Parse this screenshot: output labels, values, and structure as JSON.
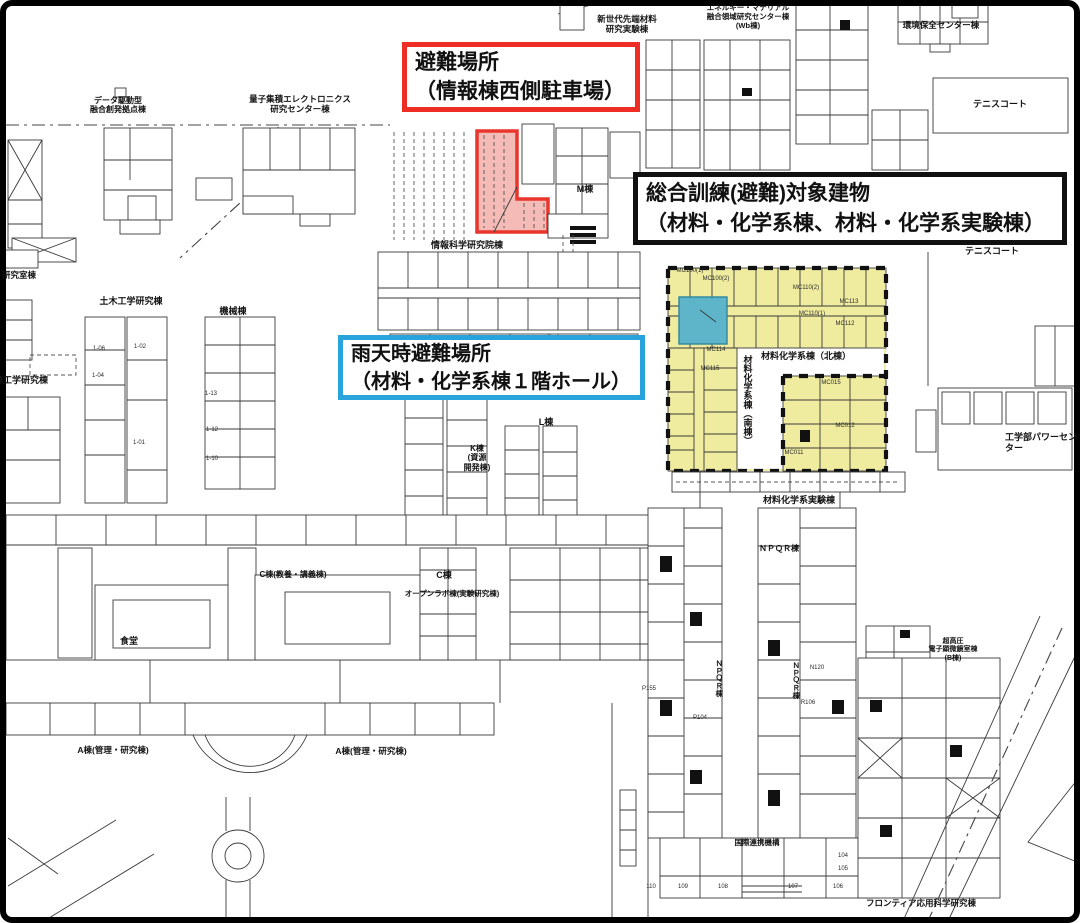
{
  "callouts": {
    "evacuation_site": {
      "line1": "避難場所",
      "line2": "（情報棟西側駐車場）",
      "border_color": "#ee2e24"
    },
    "training_target": {
      "line1": "総合訓練(避難)対象建物",
      "line2": "（材料・化学系棟、材料・化学系実験棟）",
      "border_color": "#111111"
    },
    "rainy_day_site": {
      "line1": "雨天時避難場所",
      "line2": "（材料・化学系棟１階ホール）",
      "border_color": "#29a3dc"
    }
  },
  "map": {
    "highlight_colors": {
      "parking_fill": "#f2aaa5",
      "parking_stroke": "#e8362c",
      "buildings_fill": "#efec9f",
      "hall_fill": "#5eb5ca",
      "hall_stroke": "#2e86a0",
      "dash_border": "#111111"
    },
    "labels": [
      {
        "text": "データ駆動型\n融合創発拠点棟",
        "x": 118,
        "y": 96,
        "fs": 8
      },
      {
        "text": "量子集積エレクトロニクス\n研究センター棟",
        "x": 300,
        "y": 94,
        "fs": 8.5
      },
      {
        "text": "新世代先端材料\n研究実験棟",
        "x": 627,
        "y": 14,
        "fs": 8.5
      },
      {
        "text": "エネルギー・マテリアル\n融合領域研究センター棟\n(Wb棟)",
        "x": 748,
        "y": 4,
        "fs": 7.5
      },
      {
        "text": "環境保全センター棟",
        "x": 941,
        "y": 20,
        "fs": 8.5
      },
      {
        "text": "テニスコート",
        "x": 1000,
        "y": 99,
        "fs": 9
      },
      {
        "text": "テニスコート",
        "x": 992,
        "y": 246,
        "fs": 9
      },
      {
        "text": "情報科学研究院棟",
        "x": 467,
        "y": 240,
        "fs": 9
      },
      {
        "text": "M棟",
        "x": 585,
        "y": 184,
        "fs": 9
      },
      {
        "text": "材料化学系棟（北棟）",
        "x": 806,
        "y": 351,
        "fs": 9
      },
      {
        "text": "材料化学系棟（南棟）",
        "x": 747,
        "y": 400,
        "fs": 9,
        "vert": true
      },
      {
        "text": "材料化学系実験棟",
        "x": 799,
        "y": 495,
        "fs": 9
      },
      {
        "text": "工学部パワーセンター",
        "x": 1005,
        "y": 432,
        "fs": 9,
        "align": "left"
      },
      {
        "text": "研究室棟",
        "x": 2,
        "y": 270,
        "fs": 8.5,
        "align": "left"
      },
      {
        "text": "土木工学研究棟",
        "x": 131,
        "y": 296,
        "fs": 9
      },
      {
        "text": "機械棟",
        "x": 233,
        "y": 306,
        "fs": 9
      },
      {
        "text": "境工学研究棟",
        "x": -6,
        "y": 375,
        "fs": 9,
        "align": "left"
      },
      {
        "text": "K棟\n(資源\n開発棟)",
        "x": 477,
        "y": 444,
        "fs": 8
      },
      {
        "text": "L棟",
        "x": 546,
        "y": 417,
        "fs": 9
      },
      {
        "text": "C棟",
        "x": 444,
        "y": 570,
        "fs": 9
      },
      {
        "text": "オープンラボ棟(実験研究棟)",
        "x": 452,
        "y": 590,
        "fs": 7.5
      },
      {
        "text": "C棟(教養・講義棟)",
        "x": 293,
        "y": 570,
        "fs": 8
      },
      {
        "text": "食堂",
        "x": 129,
        "y": 636,
        "fs": 9
      },
      {
        "text": "A棟(管理・研究棟)",
        "x": 113,
        "y": 745,
        "fs": 8.5
      },
      {
        "text": "A棟(管理・研究棟)",
        "x": 371,
        "y": 746,
        "fs": 8.5
      },
      {
        "text": "ＮＰＱＲ棟",
        "x": 779,
        "y": 544,
        "fs": 8
      },
      {
        "text": "ＮＰＱＲ棟",
        "x": 719,
        "y": 678,
        "fs": 7.5,
        "vert": true
      },
      {
        "text": "ＮＰＱＲ棟",
        "x": 796,
        "y": 680,
        "fs": 7.5,
        "vert": true
      },
      {
        "text": "国際連携機構",
        "x": 757,
        "y": 839,
        "fs": 7.5
      },
      {
        "text": "フロンティア応用科学研究棟",
        "x": 921,
        "y": 898,
        "fs": 8.5
      },
      {
        "text": "超高圧\n電子顕微鏡室棟\n(B棟)",
        "x": 953,
        "y": 638,
        "fs": 7
      },
      {
        "text": "MC100(1)",
        "x": 690,
        "y": 268,
        "fs": 6,
        "small": true
      },
      {
        "text": "MC100(2)",
        "x": 716,
        "y": 276,
        "fs": 6,
        "small": true
      },
      {
        "text": "MC110(2)",
        "x": 806,
        "y": 285,
        "fs": 6,
        "small": true
      },
      {
        "text": "MC110(1)",
        "x": 812,
        "y": 311,
        "fs": 6,
        "small": true
      },
      {
        "text": "MC112",
        "x": 845,
        "y": 321,
        "fs": 6,
        "small": true
      },
      {
        "text": "MC113",
        "x": 849,
        "y": 299,
        "fs": 6,
        "small": true
      },
      {
        "text": "MC114",
        "x": 716,
        "y": 347,
        "fs": 6,
        "small": true
      },
      {
        "text": "MC115",
        "x": 710,
        "y": 366,
        "fs": 6,
        "small": true
      },
      {
        "text": "MC015",
        "x": 831,
        "y": 380,
        "fs": 6,
        "small": true
      },
      {
        "text": "MC012",
        "x": 845,
        "y": 423,
        "fs": 6,
        "small": true
      },
      {
        "text": "MC011",
        "x": 794,
        "y": 450,
        "fs": 6,
        "small": true
      },
      {
        "text": "P155",
        "x": 649,
        "y": 686,
        "fs": 6,
        "small": true
      },
      {
        "text": "P104",
        "x": 700,
        "y": 715,
        "fs": 6,
        "small": true
      },
      {
        "text": "N120",
        "x": 817,
        "y": 665,
        "fs": 6,
        "small": true
      },
      {
        "text": "R106",
        "x": 808,
        "y": 700,
        "fs": 6,
        "small": true
      },
      {
        "text": "110",
        "x": 651,
        "y": 884,
        "fs": 6,
        "small": true
      },
      {
        "text": "109",
        "x": 683,
        "y": 884,
        "fs": 6,
        "small": true
      },
      {
        "text": "108",
        "x": 723,
        "y": 884,
        "fs": 6,
        "small": true
      },
      {
        "text": "107",
        "x": 793,
        "y": 884,
        "fs": 6,
        "small": true
      },
      {
        "text": "106",
        "x": 838,
        "y": 884,
        "fs": 6,
        "small": true
      },
      {
        "text": "104",
        "x": 843,
        "y": 853,
        "fs": 6,
        "small": true
      },
      {
        "text": "105",
        "x": 843,
        "y": 866,
        "fs": 6,
        "small": true
      },
      {
        "text": "1-02",
        "x": 140,
        "y": 344,
        "fs": 6,
        "small": true
      },
      {
        "text": "1-01",
        "x": 139,
        "y": 440,
        "fs": 6,
        "small": true
      },
      {
        "text": "1-06",
        "x": 99,
        "y": 346,
        "fs": 6,
        "small": true
      },
      {
        "text": "1-04",
        "x": 98,
        "y": 373,
        "fs": 6,
        "small": true
      },
      {
        "text": "1-13",
        "x": 211,
        "y": 391,
        "fs": 6,
        "small": true
      },
      {
        "text": "1-12",
        "x": 212,
        "y": 427,
        "fs": 6,
        "small": true
      },
      {
        "text": "1-10",
        "x": 212,
        "y": 456,
        "fs": 6,
        "small": true
      }
    ]
  }
}
